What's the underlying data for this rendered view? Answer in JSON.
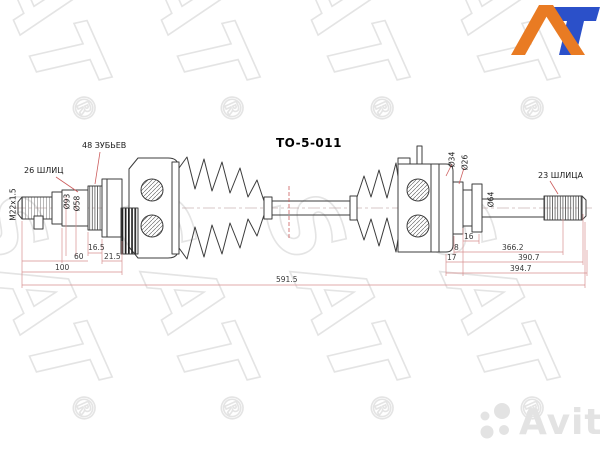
{
  "part": {
    "number": "TO-5-011"
  },
  "callouts": {
    "thread_spec": "M22x1.5",
    "outer_splines": "26 ШЛИЦ",
    "abs_teeth": "48 ЗУБЬЕВ",
    "inner_splines": "23 ШЛИЦА",
    "dia_outer_joint": "Ø93",
    "dia_boot_seat": "Ø58",
    "dia_ring": "Ø34",
    "dia_shaft": "Ø26",
    "dia_inner_joint": "Ø64"
  },
  "dimensions": {
    "outer_spline_len": "16.5",
    "outer_joint_len": "60",
    "outer_step_len": "21.5",
    "outer_assembly_len": "100",
    "overall_len": "591.5",
    "inner_spline_len": "16",
    "inner_groove_len": "8",
    "inner_stub_len": "17",
    "shaft_len": "366.2",
    "inner_len_1": "390.7",
    "inner_len_2": "394.7"
  },
  "watermarks": {
    "sat": "SAT",
    "reg": "®",
    "avito": "Avito"
  },
  "colors": {
    "at_logo_orange": "#E97B23",
    "at_logo_blue": "#2B50C9",
    "dimension_line": "#D89090",
    "drawing_line": "#3C3C3C",
    "watermark_gray": "#E4E4E4"
  }
}
